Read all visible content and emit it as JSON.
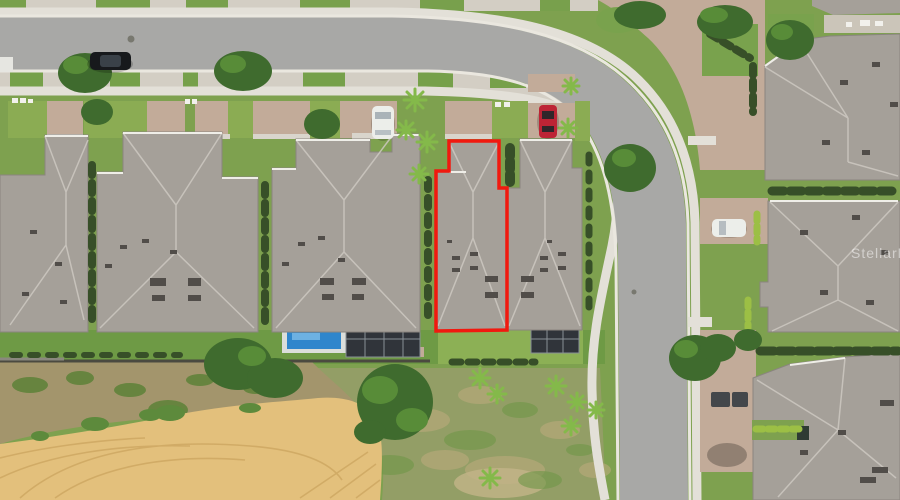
{
  "watermark": {
    "text": "StellarMLS"
  },
  "property_outline": {
    "points": "449,141 499,141 499,188 507,188 507,330 436,331 436,171 449,171",
    "color": "#f1190f",
    "stroke_width": 3.5
  },
  "colors": {
    "road": "#a8a8a6",
    "sidewalk": "#e3e0d8",
    "curb": "#eae7df",
    "concrete": "#d3cec4",
    "pavers": "#c2ab99",
    "roof": "#a5a099",
    "roof_edge": "#8a857f",
    "ridge": "#cdc8c1",
    "vent": "#514d49",
    "eave": "#efeee8",
    "lawn": "#7ea14f",
    "backyard": "#6e9a45",
    "field": "#939e66",
    "scrub": "#a3956c",
    "sand": "#e3c07c",
    "sand_track": "#c9a25c",
    "tree_dark": "#3f6b2e",
    "tree_light": "#588c38",
    "palm": "#84b94a",
    "hedge": "#374f28",
    "hedge_bright": "#9cbf45",
    "pool_water": "#2f86cc",
    "pool_deck": "#dbdedb",
    "screen": "#30343a",
    "screen_frame": "#899096",
    "fence": "#4b4a40",
    "wall_face": "#d9d5cc",
    "white_detail": "#f2f1ec",
    "car_red": "#bd2435",
    "car_white": "#eceeea",
    "car_dark": "#17191c",
    "bin": "#43474b",
    "manhole": "#78786f"
  }
}
